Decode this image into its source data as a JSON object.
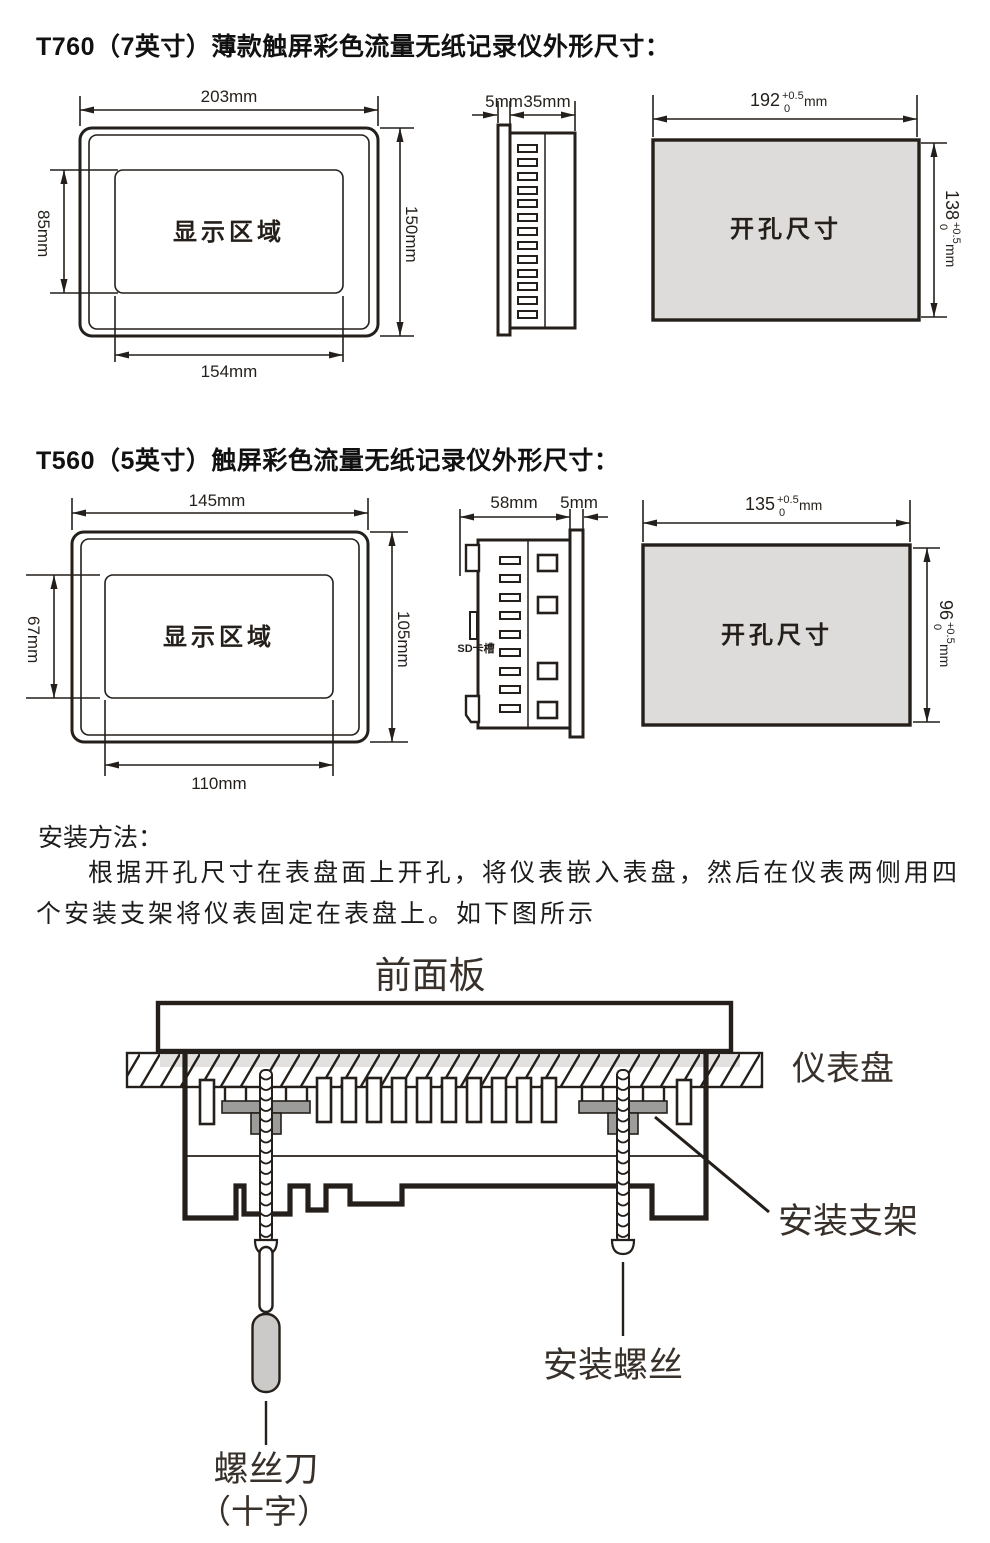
{
  "t760": {
    "title": "T760（7英寸）薄款触屏彩色流量无纸记录仪外形尺寸：",
    "front": {
      "width": "203mm",
      "display_height": "85mm",
      "height": "150mm",
      "display_width": "154mm",
      "display_area": "显示区域"
    },
    "side": {
      "panel_thickness": "5mm",
      "depth": "35mm"
    },
    "cutout": {
      "label": "开孔尺寸",
      "width": {
        "value": "192",
        "tol_plus": "+0.5",
        "tol_minus": "0",
        "unit": "mm"
      },
      "height": {
        "value": "138",
        "tol_plus": "+0.5",
        "tol_minus": "0",
        "unit": "mm"
      }
    }
  },
  "t560": {
    "title": "T560（5英寸）触屏彩色流量无纸记录仪外形尺寸：",
    "front": {
      "width": "145mm",
      "display_height": "67mm",
      "height": "105mm",
      "display_width": "110mm",
      "display_area": "显示区域"
    },
    "side": {
      "depth": "58mm",
      "panel_thickness": "5mm",
      "sd_slot": "SD卡槽"
    },
    "cutout": {
      "label": "开孔尺寸",
      "width": {
        "value": "135",
        "tol_plus": "+0.5",
        "tol_minus": "0",
        "unit": "mm"
      },
      "height": {
        "value": "96",
        "tol_plus": "+0.5",
        "tol_minus": "0",
        "unit": "mm"
      }
    }
  },
  "install": {
    "heading": "安装方法：",
    "body": "根据开孔尺寸在表盘面上开孔，将仪表嵌入表盘，然后在仪表两侧用四个安装支架将仪表固定在表盘上。如下图所示",
    "labels": {
      "front_panel": "前面板",
      "instrument_panel": "仪表盘",
      "bracket": "安装支架",
      "screw": "安装螺丝",
      "screwdriver": "螺丝刀",
      "screwdriver_type": "（十字）"
    }
  }
}
